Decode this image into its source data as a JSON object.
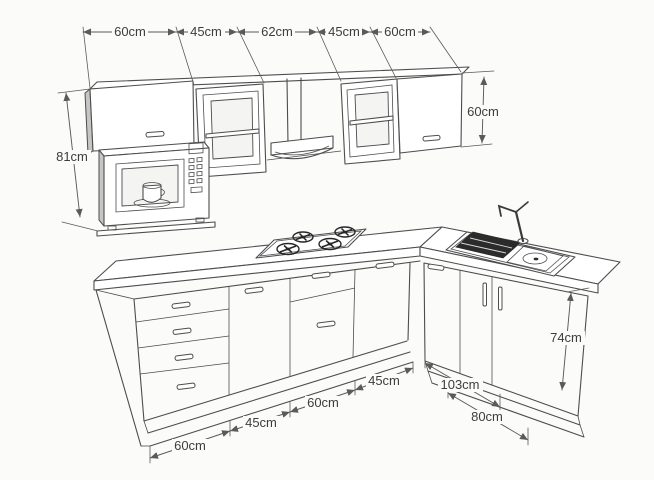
{
  "upper_run": {
    "width_labels": [
      "60cm",
      "45cm",
      "62cm",
      "45cm",
      "60cm"
    ],
    "left_stack_height_label": "81cm",
    "cabinet_height_label": "60cm"
  },
  "base_run": {
    "front_width_labels": [
      "60cm",
      "45cm",
      "60cm",
      "45cm"
    ],
    "right_run_width_labels": [
      "103cm",
      "80cm"
    ],
    "counter_height_label": "74cm"
  },
  "colors": {
    "line": "#4d4d4d",
    "dimension_line": "#5a5a5a",
    "background": "#fbfbfa",
    "text": "#3d3d3d",
    "dark_fill": "#2b2b2b"
  }
}
